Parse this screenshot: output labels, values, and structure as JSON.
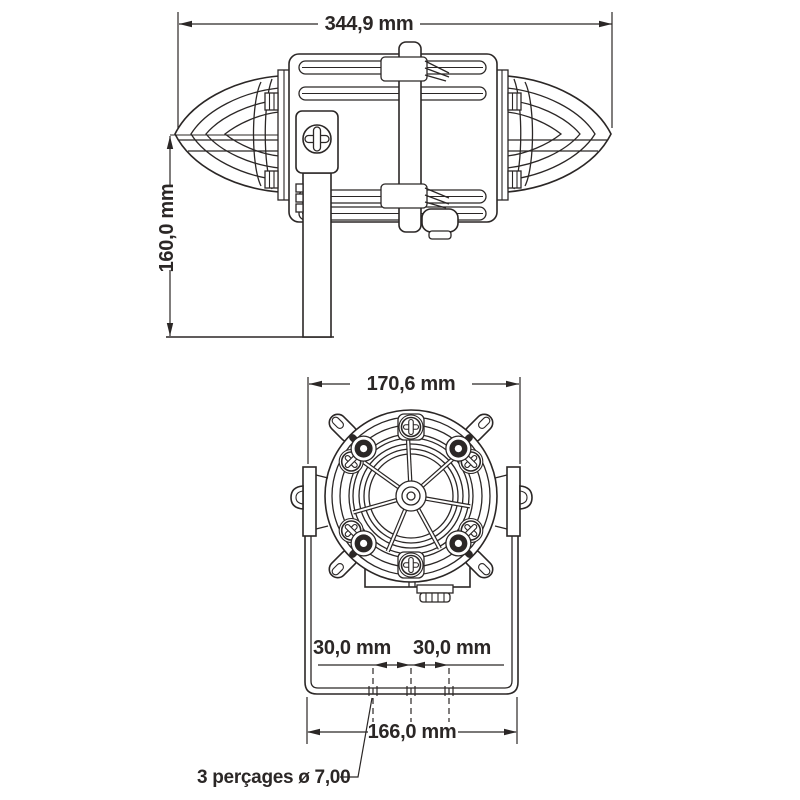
{
  "drawing": {
    "title": "beacon-sounder-dimension-drawing",
    "background": "#ffffff",
    "line_color": "#2b2726",
    "side_view": {
      "overall_width": "344,9 mm",
      "overall_height": "160,0 mm"
    },
    "front_view": {
      "overall_width": "170,6 mm",
      "hole_spacing_left": "30,0 mm",
      "hole_spacing_right": "30,0 mm",
      "mounting_width": "166,0 mm",
      "drill_note": "3 perçages ø 7,00"
    }
  }
}
